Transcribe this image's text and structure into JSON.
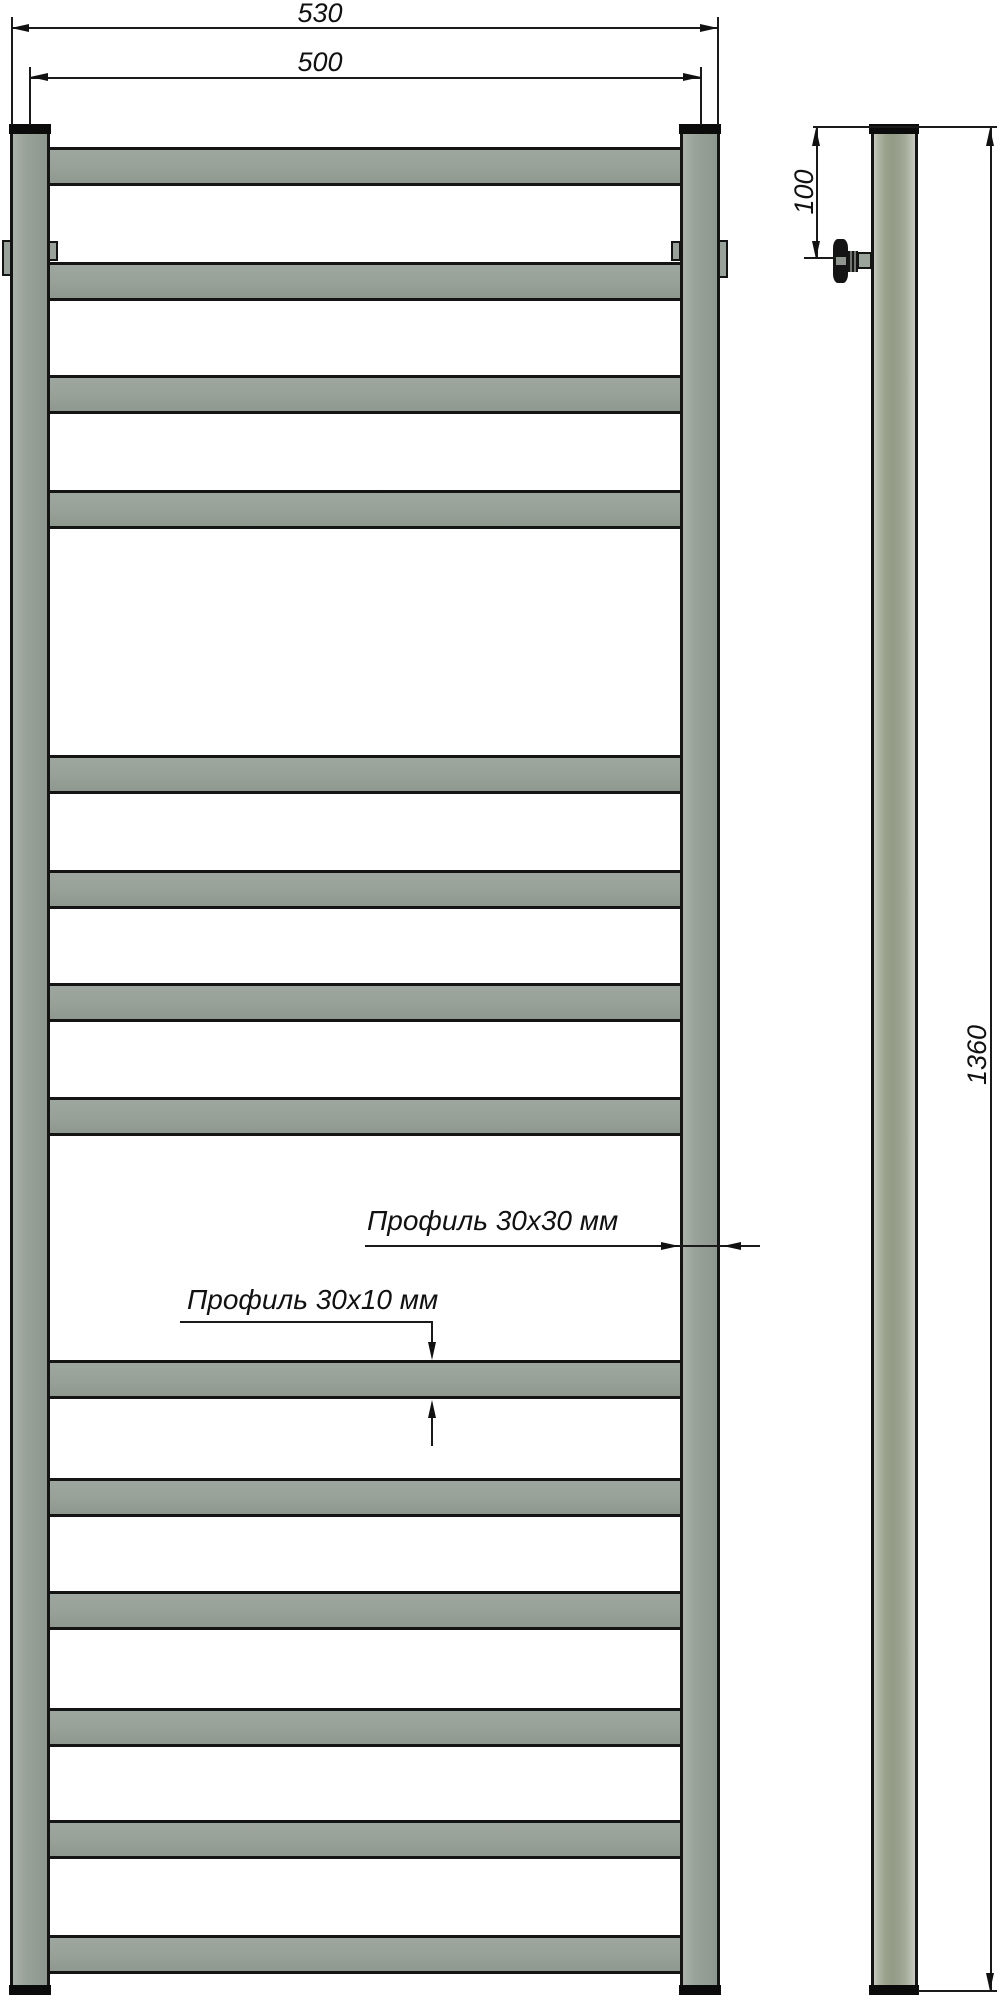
{
  "drawing": {
    "type": "technical dimension drawing",
    "subject": "ladder towel rail radiator, front and side views"
  },
  "dimensions": {
    "outer_width": "530",
    "center_width": "500",
    "valve_offset": "100",
    "height": "1360"
  },
  "labels": {
    "rail_profile": "Профиль 30х30 мм",
    "rung_profile": "Профиль 30х10 мм"
  },
  "front_view": {
    "rung_count": 14,
    "rung_tops": [
      147,
      262,
      375,
      490,
      755,
      870,
      983,
      1097,
      1360,
      1478,
      1591,
      1708,
      1820,
      1935
    ]
  },
  "colors": {
    "metal": "#97a198",
    "side_metal": "#9aa18c",
    "outline": "#141414",
    "cap": "#0b0b0b",
    "dimension": "#1a1a1a",
    "background": "#ffffff"
  }
}
